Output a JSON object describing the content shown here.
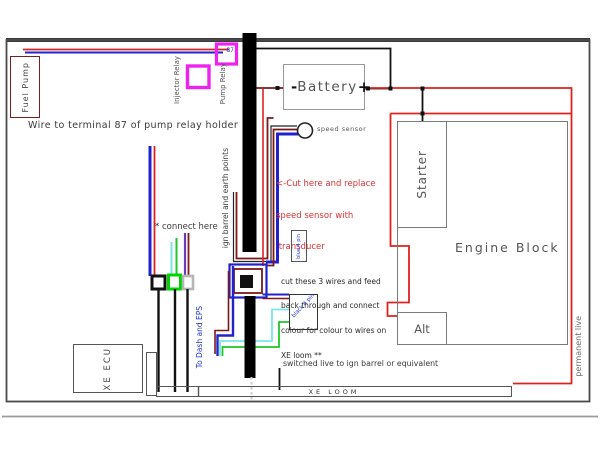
{
  "colors": {
    "wire_red": "#dd2222",
    "wire_dark_red": "#7b1818",
    "wire_blue": "#2222cc",
    "wire_cyan": "#7ae6e6",
    "wire_green": "#22c42a",
    "wire_purple": "#6a3ab8",
    "relay_magenta": "#ee22ee",
    "wire_black": "#111111",
    "frame_gray": "#4a4a4a"
  },
  "top": {
    "fuel_pump": "Fuel Pump",
    "injector_relay": "Injector Relay",
    "pump_relay": "Pump Relay",
    "relay_87": "87",
    "wire_note": "Wire to terminal 87 of pump relay holder"
  },
  "battery": {
    "minus": "-",
    "label": "Battery",
    "plus": "+"
  },
  "sensor": {
    "label": "speed sensor",
    "cut_note": [
      "<-Cut here and replace",
      "speed sensor with",
      " transducer"
    ]
  },
  "middle": {
    "ign_barrel": "ign barrel and earth points",
    "connect_here": "* connect here",
    "cut3_note": [
      "cut these 3 wires and feed",
      "back through and connect",
      "colour for colour to wires on",
      "XE loom **"
    ],
    "blue_plug": "blue 4 pin",
    "black_plug": "black 4 pin",
    "to_dash": "To Dash and EPS"
  },
  "engine": {
    "starter": "Starter",
    "engine_block": "Engine Block",
    "alt": "Alt"
  },
  "bottom": {
    "xe_ecu": "XE ECU",
    "switched_live": "switched live to ign barrel or equivalent",
    "xe_loom": "XE LOOM",
    "permanent_live": "permanent live"
  }
}
